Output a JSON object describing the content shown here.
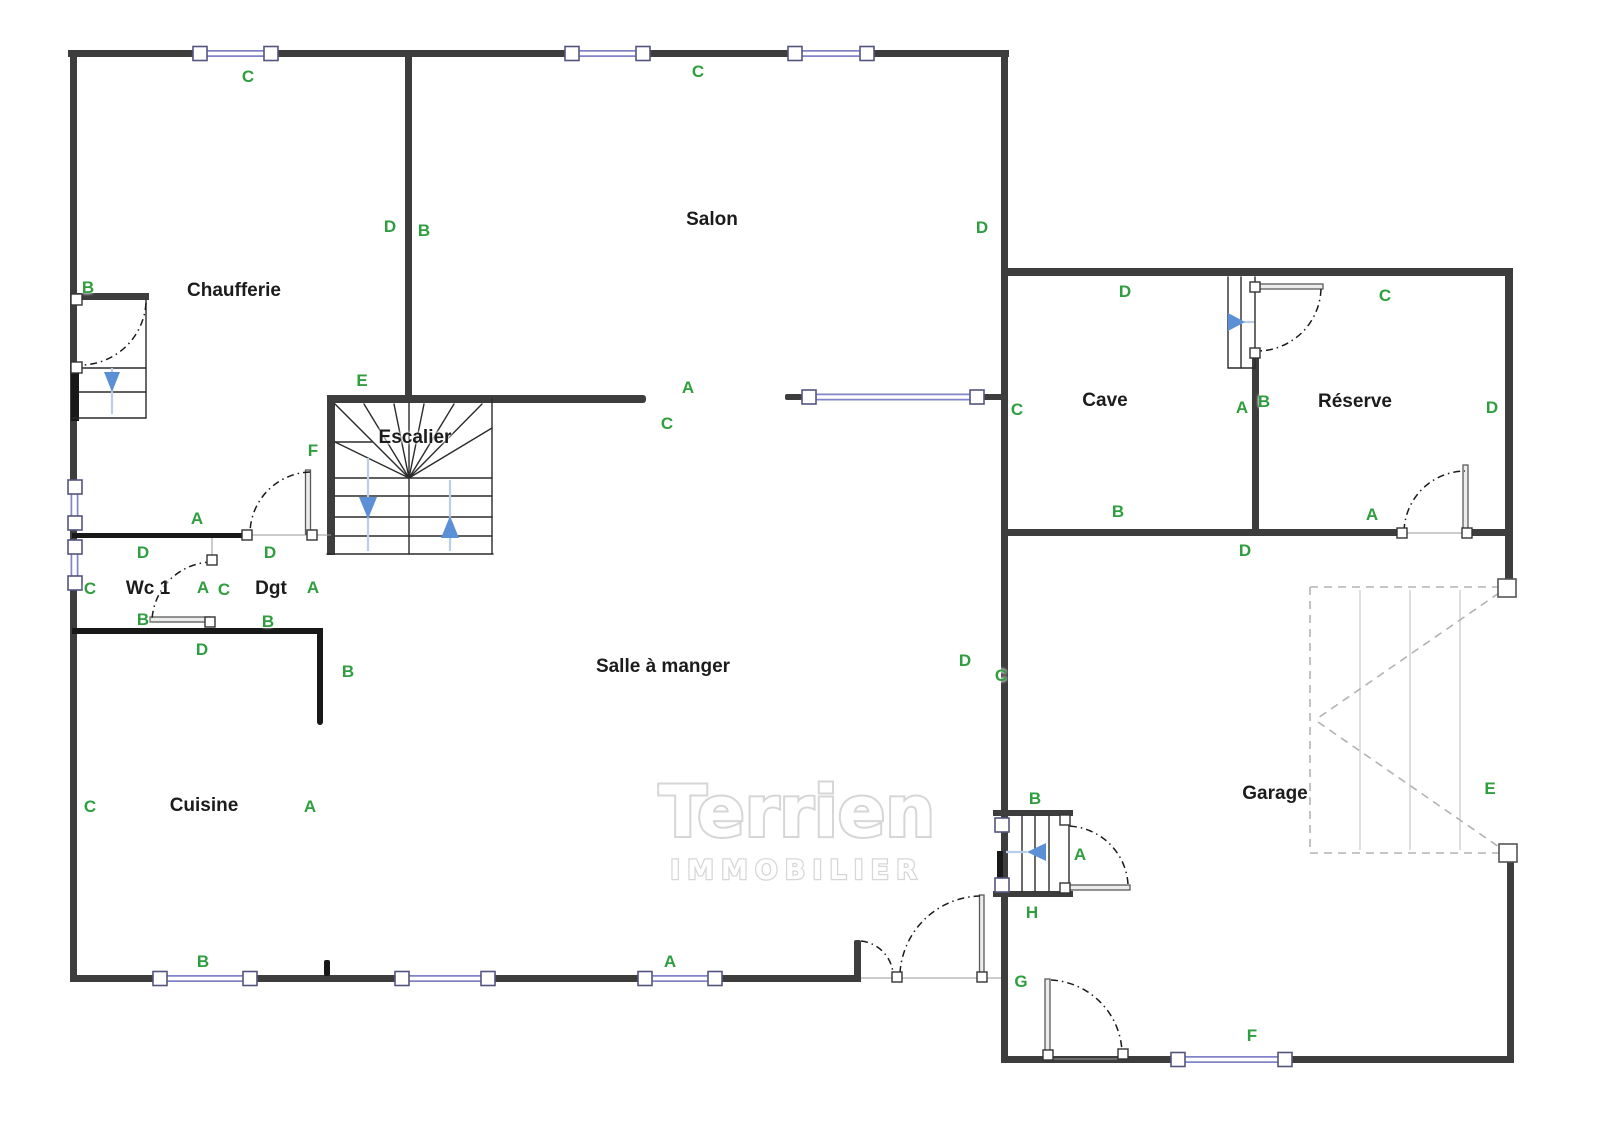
{
  "watermark": {
    "line1": "Terrien",
    "line2": "IMMOBILIER"
  },
  "rooms": [
    {
      "label": "Chaufferie",
      "x": 234,
      "y": 291
    },
    {
      "label": "Salon",
      "x": 712,
      "y": 220
    },
    {
      "label": "Escalier",
      "x": 415,
      "y": 438
    },
    {
      "label": "Wc 1",
      "x": 148,
      "y": 589
    },
    {
      "label": "Dgt",
      "x": 271,
      "y": 589
    },
    {
      "label": "Salle à manger",
      "x": 663,
      "y": 667
    },
    {
      "label": "Cuisine",
      "x": 204,
      "y": 806
    },
    {
      "label": "Cave",
      "x": 1105,
      "y": 401
    },
    {
      "label": "Réserve",
      "x": 1355,
      "y": 402
    },
    {
      "label": "Garage",
      "x": 1275,
      "y": 794
    }
  ],
  "zones": [
    {
      "label": "C",
      "x": 248,
      "y": 77
    },
    {
      "label": "C",
      "x": 698,
      "y": 72
    },
    {
      "label": "B",
      "x": 88,
      "y": 288
    },
    {
      "label": "D",
      "x": 390,
      "y": 227
    },
    {
      "label": "B",
      "x": 424,
      "y": 231
    },
    {
      "label": "D",
      "x": 982,
      "y": 228
    },
    {
      "label": "E",
      "x": 362,
      "y": 381
    },
    {
      "label": "A",
      "x": 688,
      "y": 388
    },
    {
      "label": "C",
      "x": 667,
      "y": 424
    },
    {
      "label": "C",
      "x": 1017,
      "y": 410
    },
    {
      "label": "D",
      "x": 1125,
      "y": 292
    },
    {
      "label": "C",
      "x": 1385,
      "y": 296
    },
    {
      "label": "A",
      "x": 1242,
      "y": 408
    },
    {
      "label": "B",
      "x": 1264,
      "y": 402
    },
    {
      "label": "D",
      "x": 1492,
      "y": 408
    },
    {
      "label": "F",
      "x": 313,
      "y": 451
    },
    {
      "label": "A",
      "x": 197,
      "y": 519
    },
    {
      "label": "D",
      "x": 143,
      "y": 553
    },
    {
      "label": "D",
      "x": 270,
      "y": 553
    },
    {
      "label": "C",
      "x": 90,
      "y": 589
    },
    {
      "label": "A",
      "x": 203,
      "y": 588
    },
    {
      "label": "C",
      "x": 224,
      "y": 590
    },
    {
      "label": "A",
      "x": 313,
      "y": 588
    },
    {
      "label": "B",
      "x": 143,
      "y": 620
    },
    {
      "label": "B",
      "x": 268,
      "y": 622
    },
    {
      "label": "D",
      "x": 202,
      "y": 650
    },
    {
      "label": "B",
      "x": 348,
      "y": 672
    },
    {
      "label": "B",
      "x": 1118,
      "y": 512
    },
    {
      "label": "A",
      "x": 1372,
      "y": 515
    },
    {
      "label": "D",
      "x": 1245,
      "y": 551
    },
    {
      "label": "D",
      "x": 965,
      "y": 661
    },
    {
      "label": "C",
      "x": 1001,
      "y": 676
    },
    {
      "label": "C",
      "x": 90,
      "y": 807
    },
    {
      "label": "A",
      "x": 310,
      "y": 807
    },
    {
      "label": "E",
      "x": 1490,
      "y": 789
    },
    {
      "label": "B",
      "x": 1035,
      "y": 799
    },
    {
      "label": "A",
      "x": 1080,
      "y": 855
    },
    {
      "label": "H",
      "x": 1032,
      "y": 913
    },
    {
      "label": "G",
      "x": 1021,
      "y": 982
    },
    {
      "label": "B",
      "x": 203,
      "y": 962
    },
    {
      "label": "A",
      "x": 670,
      "y": 962
    },
    {
      "label": "F",
      "x": 1252,
      "y": 1036
    }
  ],
  "colors": {
    "wall": "#3d3d3d",
    "wallb": "#181818",
    "win": "#8184c9",
    "winframe": "#54557e",
    "zone": "#2f9e3f",
    "room": "#1c1c1c",
    "arrow": "#5b8fd6",
    "arrowline": "#b9cfe9",
    "garage": "#b3b3b3",
    "watermark": "#d6d6d6"
  }
}
